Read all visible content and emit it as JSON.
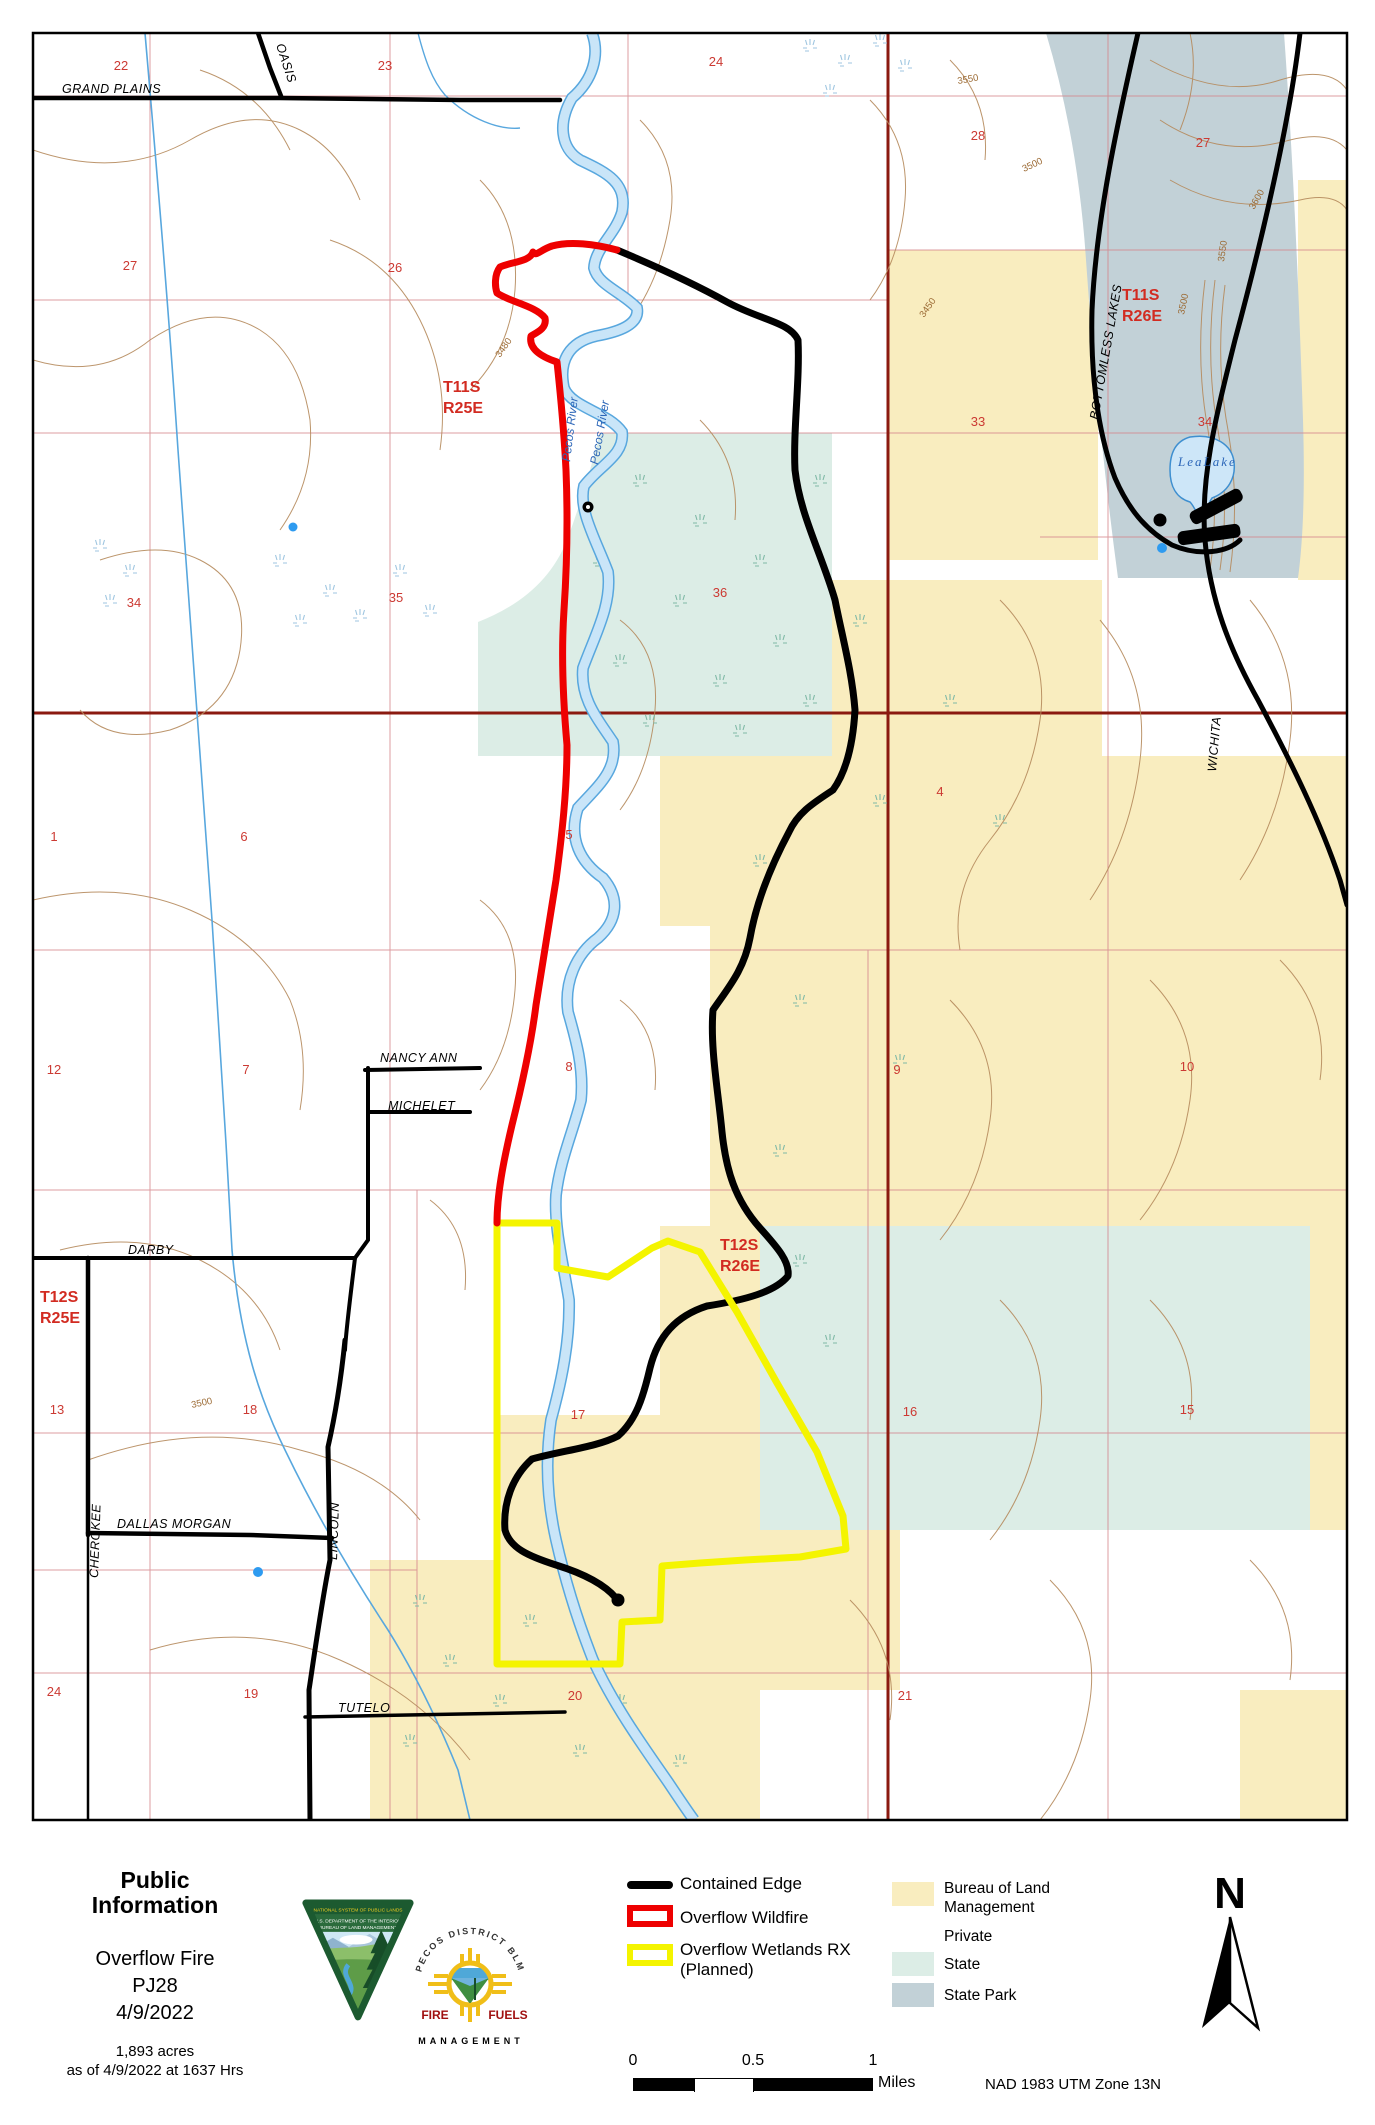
{
  "palette": {
    "blm_fill": "#F9EDBF",
    "private_fill": "#FFFFFF",
    "state_fill": "#DCEDE6",
    "state_park_fill": "#C2D1D7",
    "contained_edge": "#000000",
    "overflow_wildfire": "#EE0000",
    "overflow_rx_planned": "#F4F400",
    "contour_brown": "#B58A5C",
    "river_fill": "#C9E5F8",
    "river_edge": "#58A7DE",
    "section_grid_pink": "#D4848C",
    "township_dark_red": "#8B1A10",
    "red_label": "#D22B21",
    "marsh_teal": "#7FB9A6"
  },
  "map": {
    "townships": [
      {
        "t": "T11S",
        "r": "R25E"
      },
      {
        "t": "T12S",
        "r": "R25E"
      },
      {
        "t": "T11S",
        "r": "R26E"
      },
      {
        "t": "T12S",
        "r": "R26E"
      }
    ],
    "sections": [
      "22",
      "23",
      "24",
      "28",
      "27",
      "27",
      "26",
      "33",
      "34",
      "35",
      "36",
      "34",
      "4",
      "1",
      "6",
      "5",
      "12",
      "7",
      "8",
      "9",
      "10",
      "13",
      "18",
      "17",
      "16",
      "15",
      "24",
      "19",
      "20",
      "21"
    ],
    "roads": [
      "GRAND PLAINS",
      "OASIS",
      "NANCY ANN",
      "MICHELET",
      "DARBY",
      "DALLAS MORGAN",
      "CHEROKEE",
      "LINCOLN",
      "TUTELO",
      "BOTTOMLESS LAKES",
      "WICHITA"
    ],
    "water": {
      "river1": "Pecos River",
      "river2": "Pecos River",
      "lake": "LeaLake"
    },
    "contour_labels": [
      "3550",
      "3500",
      "3600",
      "3550",
      "3500",
      "3450",
      "3480",
      "3500"
    ]
  },
  "footer": {
    "title_line1": "Public",
    "title_line2": "Information",
    "fire_name": "Overflow Fire",
    "fire_code": "PJ28",
    "fire_date": "4/9/2022",
    "acres": "1,893 acres",
    "as_of": "as of 4/9/2022 at 1637 Hrs",
    "legend": {
      "contained": "Contained Edge",
      "wildfire": "Overflow Wildfire",
      "rx_line1": "Overflow Wetlands RX",
      "rx_line2": "(Planned)"
    },
    "ownership": {
      "blm_line1": "Bureau of Land",
      "blm_line2": "Management",
      "private": "Private",
      "state": "State",
      "state_park": "State Park"
    },
    "scale": {
      "t0": "0",
      "t1": "0.5",
      "t2": "1",
      "unit": "Miles"
    },
    "north": "N",
    "datum": "NAD 1983 UTM Zone 13N",
    "logos": {
      "blm_band1": "NATIONAL SYSTEM OF PUBLIC LANDS",
      "blm_band2": "U.S. DEPARTMENT OF THE INTERIOR",
      "blm_band3": "BUREAU OF LAND MANAGEMENT",
      "pecos_arc": "PECOS DISTRICT BLM",
      "pecos_fire": "FIRE",
      "pecos_fuels": "FUELS",
      "pecos_mgmt": "MANAGEMENT"
    }
  }
}
